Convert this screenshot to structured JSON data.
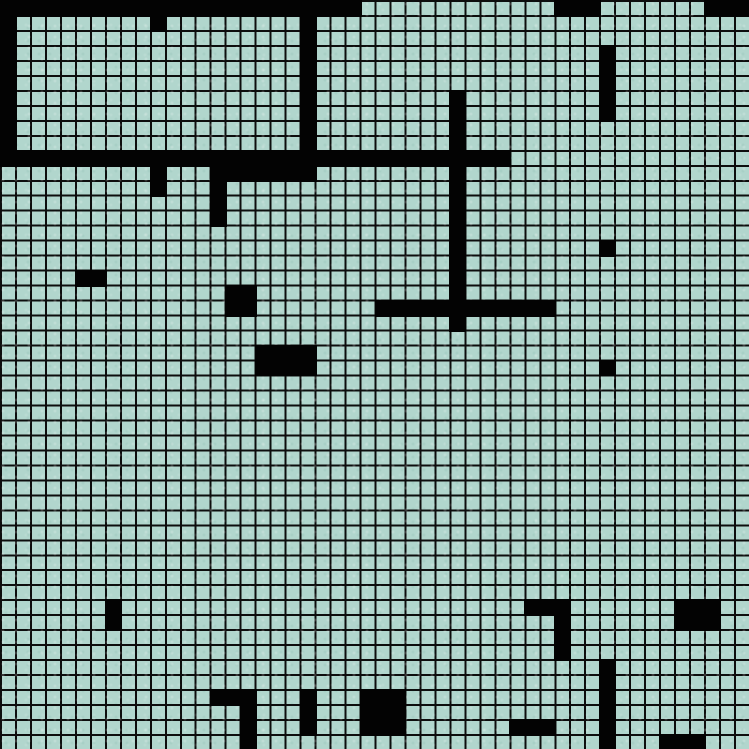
{
  "grid": {
    "cols": 50,
    "rows": 50,
    "width_px": 749,
    "height_px": 749,
    "cell_size_px": 14.98,
    "cell_color": "#b1d6cd",
    "gridline_color": "#0d0d0d",
    "gridline_width_px": 2,
    "wall_color": "#030303"
  },
  "walls": [
    {
      "col": 0,
      "row": 0,
      "w": 24,
      "h": 1
    },
    {
      "col": 37,
      "row": 0,
      "w": 3,
      "h": 1
    },
    {
      "col": 47,
      "row": 0,
      "w": 3,
      "h": 1
    },
    {
      "col": 0,
      "row": 0,
      "w": 1,
      "h": 11
    },
    {
      "col": 20,
      "row": 0,
      "w": 1,
      "h": 11
    },
    {
      "col": 10,
      "row": 1,
      "w": 1,
      "h": 1
    },
    {
      "col": 40,
      "row": 3,
      "w": 1,
      "h": 5
    },
    {
      "col": 30,
      "row": 6,
      "w": 1,
      "h": 16
    },
    {
      "col": 0,
      "row": 10,
      "w": 34,
      "h": 1
    },
    {
      "col": 10,
      "row": 11,
      "w": 1,
      "h": 2
    },
    {
      "col": 14,
      "row": 11,
      "w": 1,
      "h": 4
    },
    {
      "col": 15,
      "row": 11,
      "w": 6,
      "h": 1
    },
    {
      "col": 40,
      "row": 16,
      "w": 1,
      "h": 1
    },
    {
      "col": 5,
      "row": 18,
      "w": 2,
      "h": 1
    },
    {
      "col": 15,
      "row": 19,
      "w": 2,
      "h": 2
    },
    {
      "col": 25,
      "row": 20,
      "w": 12,
      "h": 1
    },
    {
      "col": 17,
      "row": 23,
      "w": 4,
      "h": 2
    },
    {
      "col": 40,
      "row": 24,
      "w": 1,
      "h": 1
    },
    {
      "col": 7,
      "row": 40,
      "w": 1,
      "h": 2
    },
    {
      "col": 35,
      "row": 40,
      "w": 3,
      "h": 1
    },
    {
      "col": 37,
      "row": 40,
      "w": 1,
      "h": 4
    },
    {
      "col": 45,
      "row": 40,
      "w": 3,
      "h": 2
    },
    {
      "col": 40,
      "row": 44,
      "w": 1,
      "h": 6
    },
    {
      "col": 14,
      "row": 46,
      "w": 3,
      "h": 1
    },
    {
      "col": 16,
      "row": 46,
      "w": 1,
      "h": 4
    },
    {
      "col": 20,
      "row": 46,
      "w": 1,
      "h": 3
    },
    {
      "col": 24,
      "row": 46,
      "w": 3,
      "h": 3
    },
    {
      "col": 34,
      "row": 48,
      "w": 3,
      "h": 1
    },
    {
      "col": 44,
      "row": 49,
      "w": 3,
      "h": 1
    }
  ]
}
